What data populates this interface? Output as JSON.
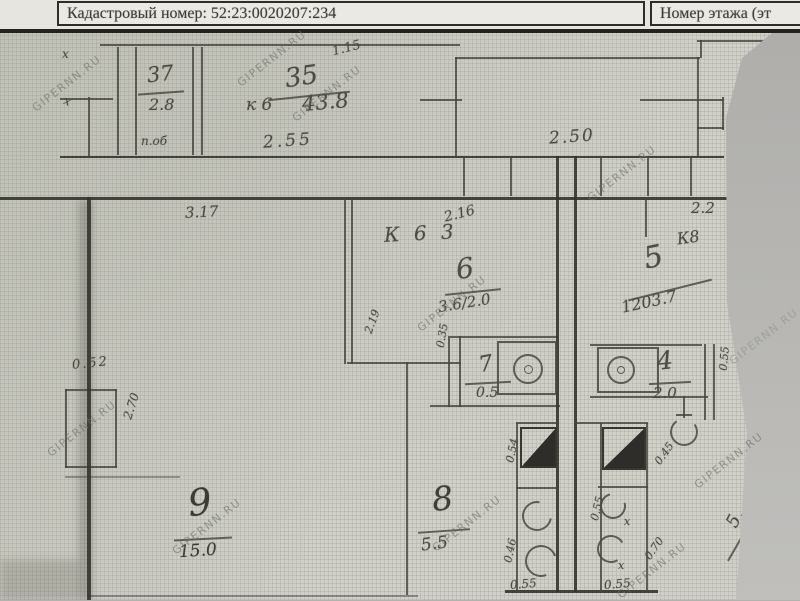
{
  "header": {
    "cadastral_label": "Кадастровый номер: 52:23:0020207:234",
    "floor_label": "Номер этажа (эт"
  },
  "watermark": "GIPERNN.RU",
  "plan": {
    "room37": {
      "num": "37",
      "den": "2.8",
      "caption": "п.об"
    },
    "flat_label": {
      "prefix": "к 6",
      "num": "35",
      "den": "43.8"
    },
    "room6": {
      "num": "6",
      "den": "3.6/2.0"
    },
    "room5": {
      "num": "5",
      "sup": "К8",
      "den": "1203.7"
    },
    "room7": {
      "num": "7",
      "den": "0.5"
    },
    "room4": {
      "num": "4",
      "den": "2.0"
    },
    "room8": {
      "num": "8",
      "den": "5.5"
    },
    "room9": {
      "num": "9",
      "den": "15.0"
    },
    "room5b": {
      "num": "5,"
    },
    "dims": {
      "d1_15": "1.15",
      "d2_55": "2.55",
      "d2_50": "2.50",
      "d3_17": "3.17",
      "k63": "К 6 3",
      "d2_16": "2.16",
      "d2_2": "2.2",
      "d0_52": "0.52",
      "d2_70": "2.70",
      "d0_55": "0.55",
      "d0_54": "0.54",
      "d0_46": "0.46",
      "d0_45": "0.45",
      "d0_70": "0.70",
      "d0_35": "0.35",
      "d2_19": "2.19",
      "x": "х"
    }
  }
}
